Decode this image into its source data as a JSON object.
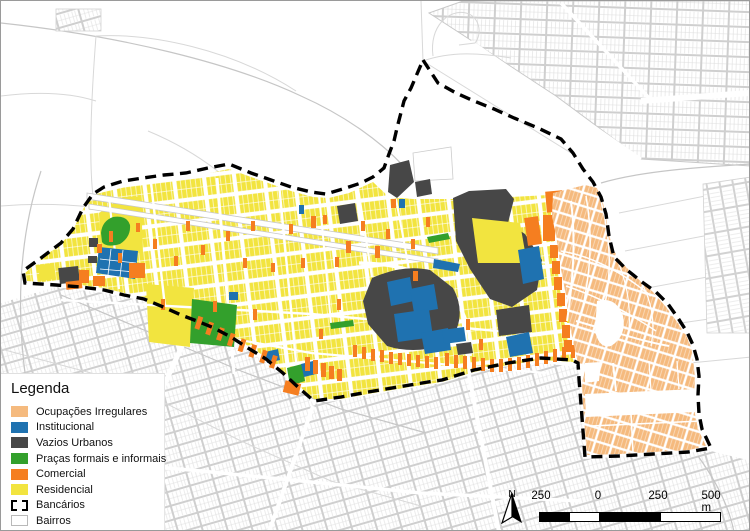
{
  "legend": {
    "title": "Legenda",
    "items": [
      {
        "label": "Ocupações Irregulares",
        "type": "fill",
        "color_key": "ocupacoes_irregulares"
      },
      {
        "label": "Institucional",
        "type": "fill",
        "color_key": "institucional"
      },
      {
        "label": "Vazios Urbanos",
        "type": "fill",
        "color_key": "vazios_urbanos"
      },
      {
        "label": "Praças formais e informais",
        "type": "fill",
        "color_key": "pracas"
      },
      {
        "label": "Comercial",
        "type": "fill",
        "color_key": "comercial"
      },
      {
        "label": "Residencial",
        "type": "fill",
        "color_key": "residencial"
      },
      {
        "label": "Bancários",
        "type": "dashed-outline",
        "color_key": "boundary"
      },
      {
        "label": "Bairros",
        "type": "outline",
        "color_key": "bairros_outline"
      }
    ]
  },
  "scale_bar": {
    "labels": [
      "250",
      "0",
      "250",
      "500 m"
    ],
    "segments": [
      "black",
      "white",
      "black",
      "white"
    ]
  },
  "north_arrow": {
    "label": "N"
  },
  "colors": {
    "residencial": "#F2E43F",
    "comercial": "#F57E20",
    "institucional": "#1F72B0",
    "vazios_urbanos": "#474747",
    "pracas": "#33A02C",
    "ocupacoes_irregulares": "#F5BA7E",
    "boundary": "#000000",
    "bairros_outline": "#B9B9B9",
    "outside_streets": "#CFCFCF"
  }
}
